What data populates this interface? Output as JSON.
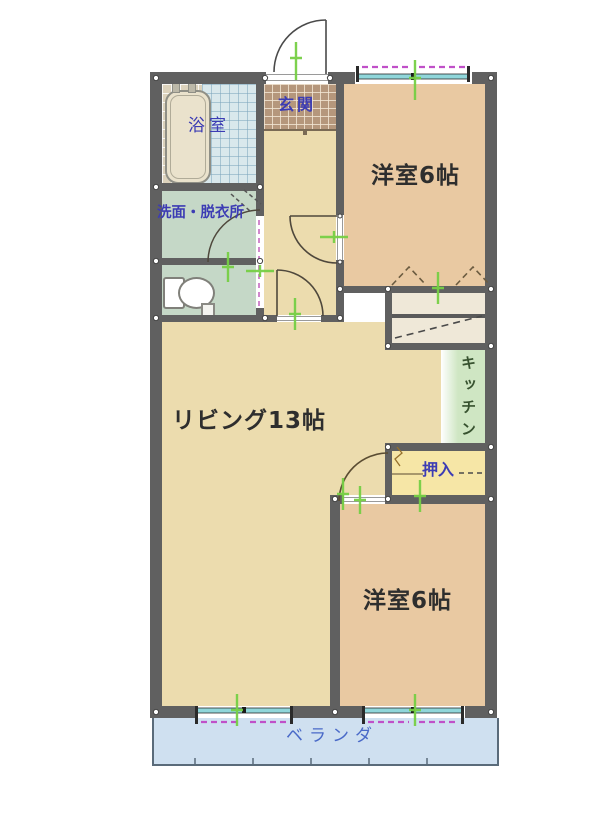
{
  "title": "2LDK間取り図",
  "rooms": {
    "bathroom": {
      "label": "浴室"
    },
    "entrance": {
      "label": "玄関"
    },
    "washroom": {
      "label": "洗面・脱衣所"
    },
    "bedroom_top": {
      "label": "洋室6帖"
    },
    "living": {
      "label": "リビング13帖"
    },
    "kitchen": {
      "label": "キッチン"
    },
    "closet_oshiire": {
      "label": "押入"
    },
    "bedroom_bottom": {
      "label": "洋室6帖"
    },
    "veranda": {
      "label": "ベランダ"
    }
  },
  "palette": {
    "wall": "#606060",
    "bedroom_fill": "#e9c9a2",
    "living_fill": "#ecdcae",
    "washroom_fill": "#c5d8c7",
    "kitchen_fill": "#cfe6c3",
    "oshiire_fill": "#f6e6a6",
    "closet_fill": "#efe8d8",
    "veranda_fill": "#cfe0f0",
    "genkan_tile": "#b5977c",
    "bath_tile_blue": "#d9e8ec",
    "window_glass": "#8fd6da",
    "window_dash": "#c050c8",
    "measure_tick": "#76cf45",
    "label_blue": "#3c3cb4",
    "label_dark": "#2e2e2e"
  }
}
